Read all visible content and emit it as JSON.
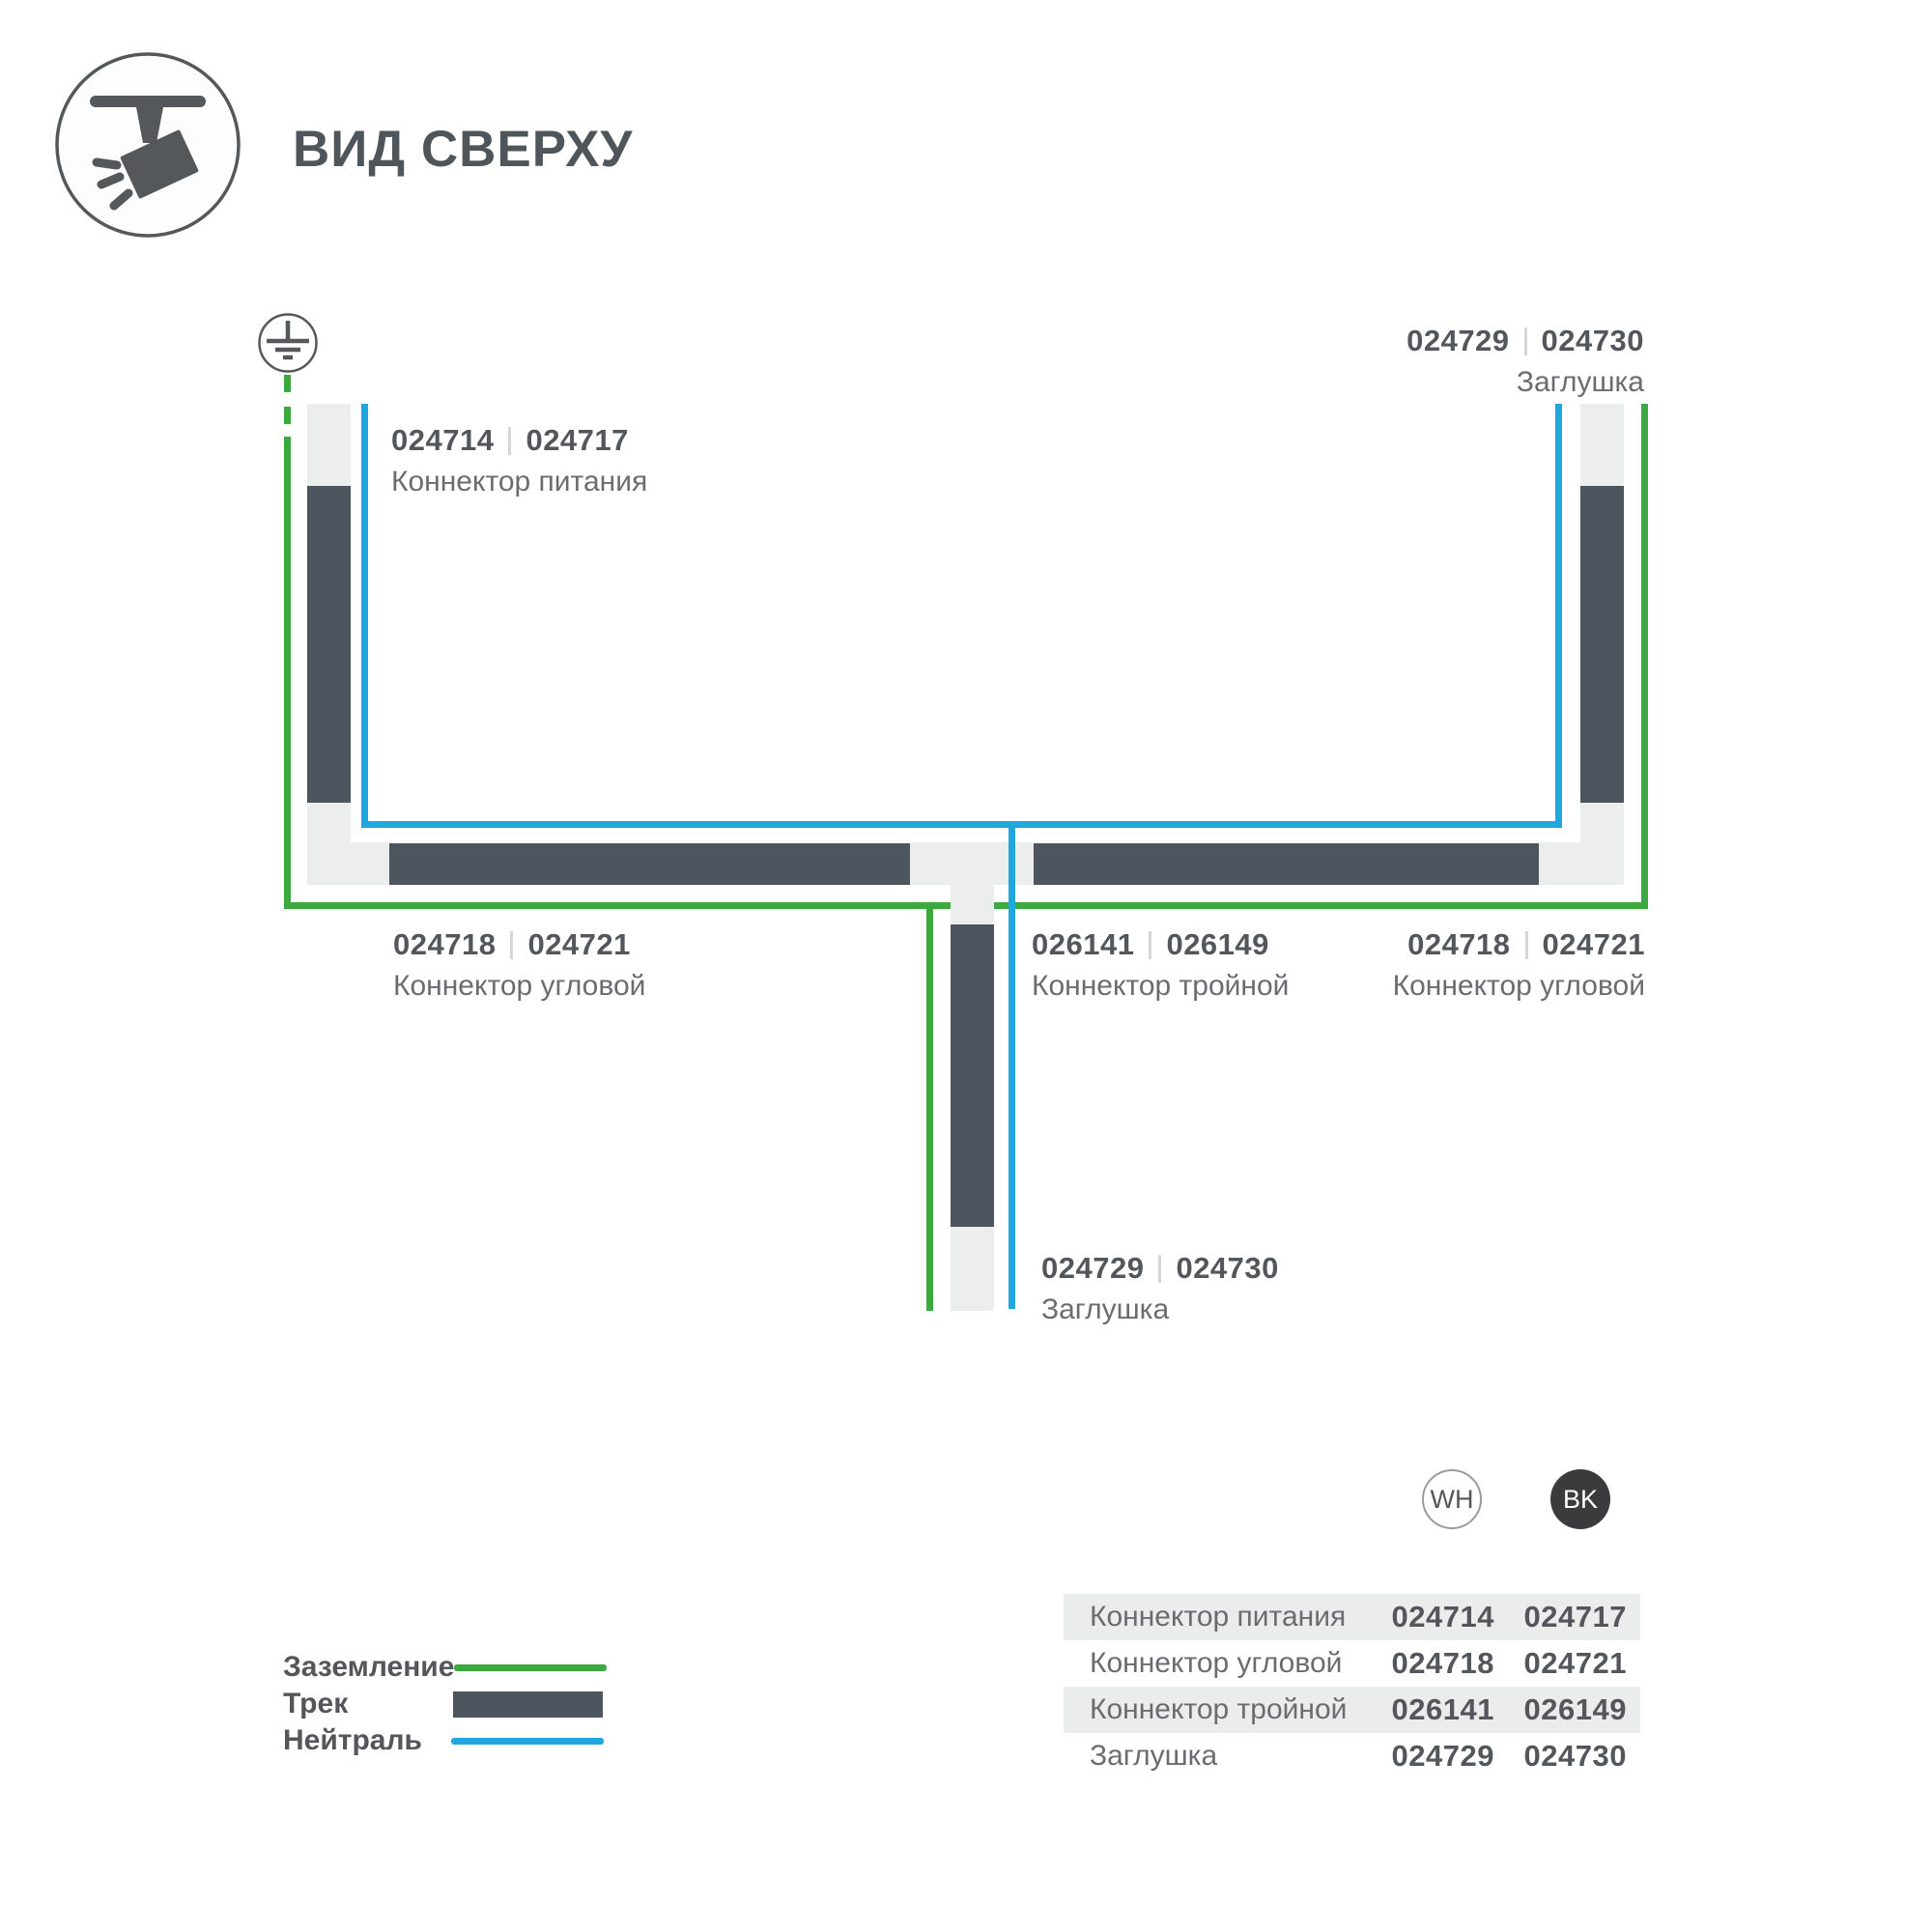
{
  "header": {
    "title": "ВИД СВЕРХУ",
    "icon": "track-spotlight-icon"
  },
  "colors": {
    "ground_green": "#3BA93F",
    "neutral_blue": "#21A7DE",
    "track_dark": "#4D565E",
    "connector_light": "#ECEDED",
    "bk_badge": "#3B3B3D"
  },
  "diagram": {
    "ground_icon": "earth-ground-icon",
    "labels": {
      "power": {
        "codes": [
          "024714",
          "024717"
        ],
        "name": "Коннектор питания"
      },
      "endcap_top": {
        "codes": [
          "024729",
          "024730"
        ],
        "name": "Заглушка"
      },
      "corner_left": {
        "codes": [
          "024718",
          "024721"
        ],
        "name": "Коннектор угловой"
      },
      "tee": {
        "codes": [
          "026141",
          "026149"
        ],
        "name": "Коннектор тройной"
      },
      "corner_right": {
        "codes": [
          "024718",
          "024721"
        ],
        "name": "Коннектор угловой"
      },
      "endcap_bottom": {
        "codes": [
          "024729",
          "024730"
        ],
        "name": "Заглушка"
      }
    }
  },
  "legend": {
    "items": [
      {
        "label": "Заземление",
        "swatch": "ground-line"
      },
      {
        "label": "Трек",
        "swatch": "track-bar"
      },
      {
        "label": "Нейтраль",
        "swatch": "neutral-line"
      }
    ]
  },
  "variants": [
    {
      "label": "WH"
    },
    {
      "label": "BK"
    }
  ],
  "table": {
    "rows": [
      {
        "name": "Коннектор питания",
        "wh": "024714",
        "bk": "024717"
      },
      {
        "name": "Коннектор угловой",
        "wh": "024718",
        "bk": "024721"
      },
      {
        "name": "Коннектор тройной",
        "wh": "026141",
        "bk": "026149"
      },
      {
        "name": "Заглушка",
        "wh": "024729",
        "bk": "024730"
      }
    ]
  }
}
